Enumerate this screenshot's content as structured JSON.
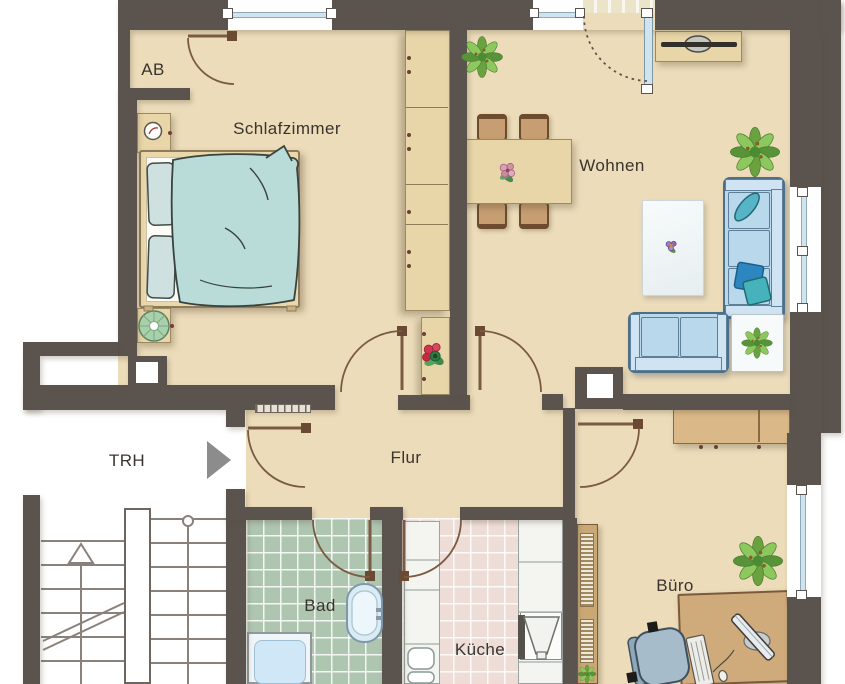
{
  "plan": {
    "rooms": {
      "ab": {
        "label": "AB"
      },
      "schlafzimmer": {
        "label": "Schlafzimmer"
      },
      "wohnen": {
        "label": "Wohnen"
      },
      "trh": {
        "label": "TRH"
      },
      "flur": {
        "label": "Flur"
      },
      "bad": {
        "label": "Bad"
      },
      "kueche": {
        "label": "Küche"
      },
      "buero": {
        "label": "Büro"
      }
    },
    "furniture": {
      "schlafzimmer": [
        "double-bed",
        "wardrobe",
        "nightstand-with-lamp",
        "round-stool"
      ],
      "wohnen": [
        "dining-table-with-four-chairs",
        "tv-sideboard",
        "three-seat-sofa",
        "loveseat",
        "rug-with-flower",
        "side-table-with-plant",
        "potted-plant",
        "potted-plant"
      ],
      "flur": [
        "console-with-flowers",
        "radiator"
      ],
      "bad": [
        "bathtub",
        "washbasin"
      ],
      "kueche": [
        "counter-with-sink",
        "stove-with-extractor-hood"
      ],
      "buero": [
        "sideboard",
        "desk-with-computer",
        "office-chair",
        "bookshelf-with-plant",
        "potted-plant"
      ],
      "trh": [
        "staircase-up",
        "entry-arrow"
      ]
    },
    "colors": {
      "wall": "#5b544e",
      "floor": "#ecdcba",
      "tileBad": "#aec5b0",
      "tileKueche": "#eedcd7",
      "doorWood": "#7a5a42",
      "furnWood": "#e9d6a8",
      "woodDark": "#c9a876",
      "sofa": "#b9d8ec",
      "duvet": "#b9dcd8",
      "glass": "#cfe4ee",
      "counter": "#f4f4f1",
      "stair": "#8a827a",
      "text": "#3a342e",
      "plant": "#6aa23f",
      "entryArrow": "#8c8c8c"
    }
  }
}
